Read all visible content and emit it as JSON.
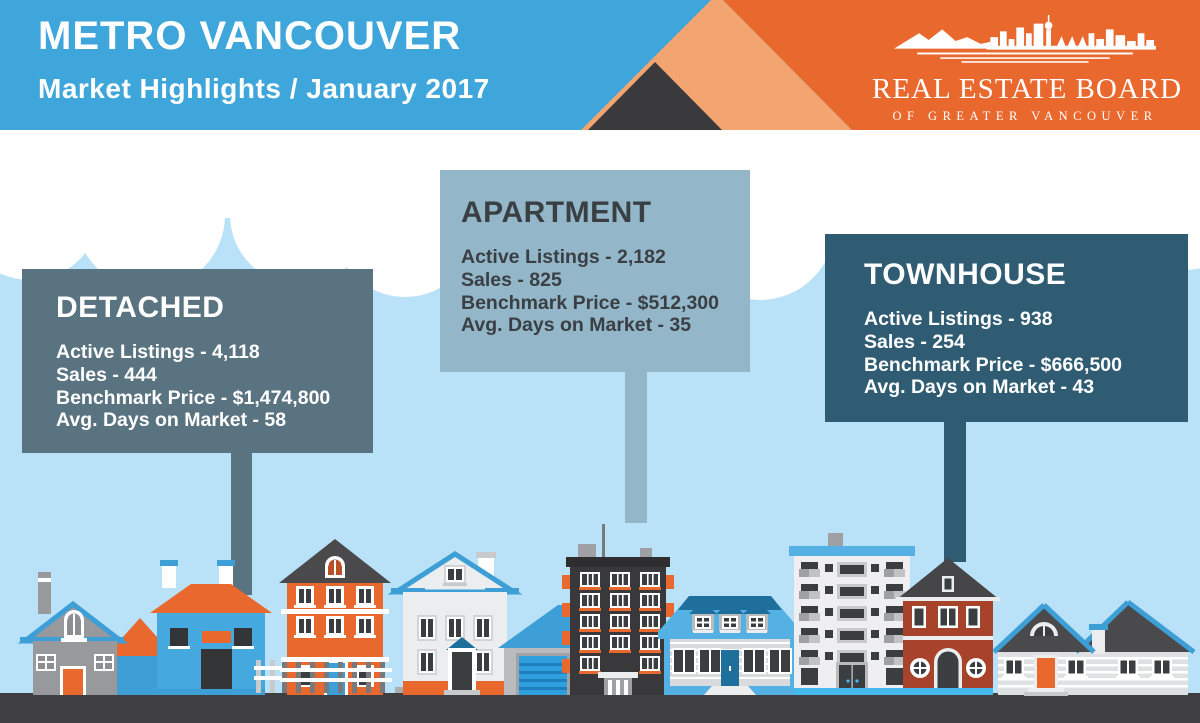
{
  "header": {
    "title": "METRO VANCOUVER",
    "subtitle": "Market Highlights / January 2017",
    "logo": {
      "name": "REAL ESTATE BOARD",
      "tagline": "OF GREATER VANCOUVER"
    }
  },
  "cards": {
    "detached": {
      "title": "DETACHED",
      "lines": [
        "Active Listings - 4,118",
        "Sales - 444",
        "Benchmark Price - $1,474,800",
        "Avg. Days on Market - 58"
      ]
    },
    "apartment": {
      "title": "APARTMENT",
      "lines": [
        "Active Listings - 2,182",
        "Sales - 825",
        "Benchmark Price - $512,300",
        "Avg. Days on Market - 35"
      ]
    },
    "townhouse": {
      "title": "TOWNHOUSE",
      "lines": [
        "Active Listings - 938",
        "Sales - 254",
        "Benchmark Price - $666,500",
        "Avg. Days on Market - 43"
      ]
    }
  },
  "colors": {
    "header_blue": "#3FA6DC",
    "brand_orange": "#E8682E",
    "light_orange": "#F2A571",
    "dark_triangle": "#3A3A3C",
    "sky": "#B9E1F7",
    "cloud": "#FFFFFF",
    "card_detached": "#5A7380",
    "card_apartment": "#93B6C9",
    "card_townhouse": "#2F5C73",
    "ground": "#3F3F41"
  }
}
